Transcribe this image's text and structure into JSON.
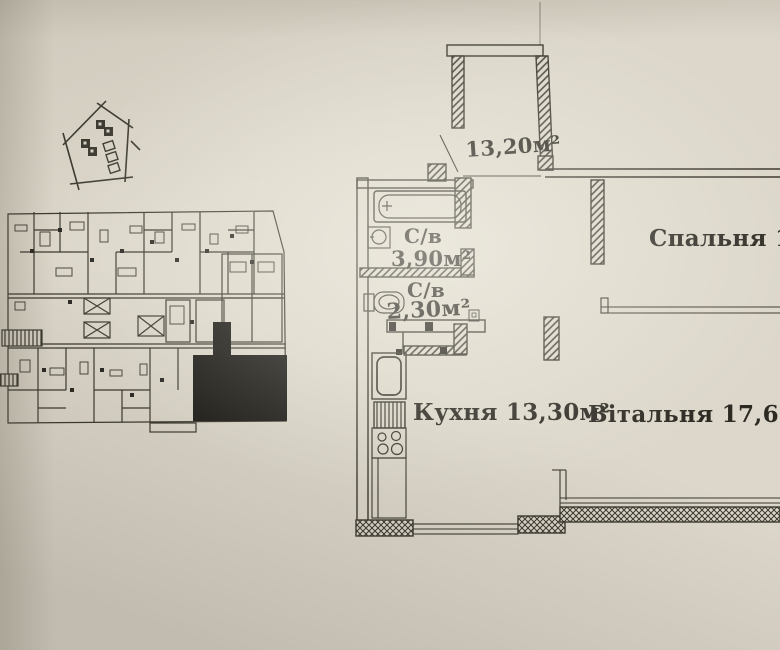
{
  "apartment": {
    "balcony_area": "13,20м²",
    "bathroom_label": "С/в",
    "bathroom_area": "3,90м²",
    "wc_label": "С/в",
    "wc_area": "2,30м²",
    "kitchen_label": "Кухня 13,30м²",
    "bedroom_label": "Спальня 15,90",
    "living_room_label": "Вітальня 17,60м²"
  },
  "colors": {
    "paper": "#dcd7ca",
    "ink": "#3a372e",
    "text_ink": "#2c2a23",
    "highlight_fill": "#1c1b17"
  }
}
